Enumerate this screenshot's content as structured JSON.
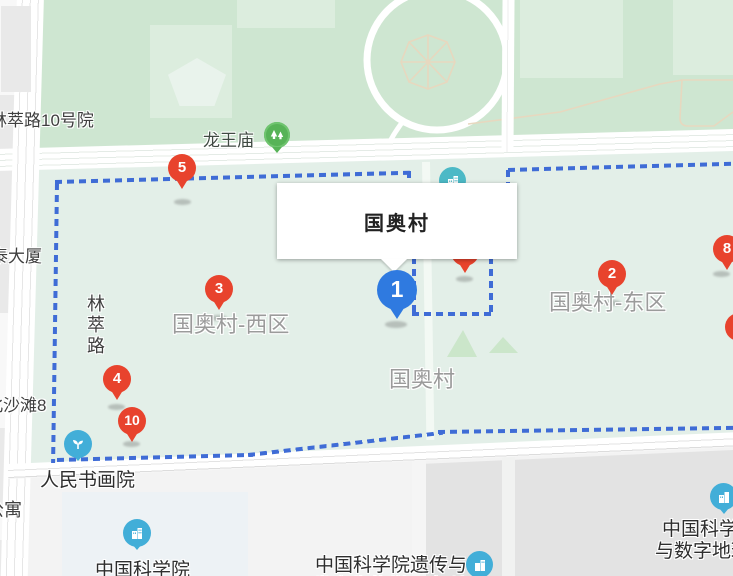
{
  "infobox": {
    "title": "国奥村"
  },
  "markers": {
    "m1": {
      "label": "1",
      "color": "blue"
    },
    "m2": {
      "label": "2",
      "color": "red"
    },
    "m3": {
      "label": "3",
      "color": "red"
    },
    "m4": {
      "label": "4",
      "color": "red"
    },
    "m5": {
      "label": "5",
      "color": "red"
    },
    "m8": {
      "label": "8",
      "color": "red"
    },
    "m10": {
      "label": "10",
      "color": "red"
    },
    "m_hidden": {
      "label": "",
      "color": "red"
    },
    "m_edge": {
      "label": "",
      "color": "red"
    }
  },
  "area_labels": {
    "west": "国奥村-西区",
    "east": "国奥村-东区",
    "center": "国奥村"
  },
  "poi_labels": {
    "longwangmiao": "龙王庙",
    "renmin_academy": "人民书画院",
    "cas": "中国科学院",
    "genetics_line1": "中国科学院遗传与",
    "genetics_line2": "发育生物学研究所",
    "digital_line1": "中国科学",
    "digital_line2": "与数字地球"
  },
  "street_labels": {
    "lincuilu_10": "林萃路10号院",
    "tai_dasha": "泰大厦",
    "lincuilu": "林萃路",
    "beishatan8": "北沙滩8",
    "gongyu": "公寓"
  },
  "colors": {
    "park_green": "#cee6d1",
    "park_green_light": "#dcedde",
    "mint": "#e3efe8",
    "boundary_blue": "#3f6cd6",
    "marker_red": "#e8432d",
    "marker_blue": "#2f7ae0",
    "poi_teal": "#4cb9c6",
    "poi_blue": "#42aed8",
    "poi_green": "#57b357",
    "area_label_gray": "#9b9b9b",
    "road_white": "#ffffff",
    "building_gray": "#e9e9e9"
  }
}
